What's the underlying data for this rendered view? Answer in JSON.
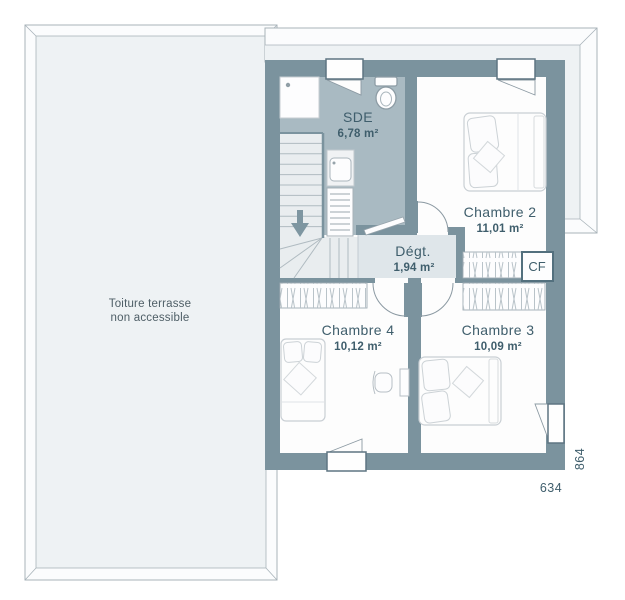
{
  "plan": {
    "rooms": [
      {
        "id": "sde",
        "name": "SDE",
        "area": "6,78 m²"
      },
      {
        "id": "chambre2",
        "name": "Chambre 2",
        "area": "11,01 m²"
      },
      {
        "id": "degagement",
        "name": "Dégt.",
        "area": "1,94 m²"
      },
      {
        "id": "chambre4",
        "name": "Chambre 4",
        "area": "10,12 m²"
      },
      {
        "id": "chambre3",
        "name": "Chambre 3",
        "area": "10,09 m²"
      }
    ],
    "terrace": {
      "label_line1": "Toiture terrasse",
      "label_line2": "non accessible"
    },
    "annotations": {
      "flue": "CF"
    },
    "dimensions": {
      "vertical": "864",
      "horizontal": "634"
    },
    "colors": {
      "wall": "#7b939e",
      "sde_floor": "#a9bac2",
      "hall_floor": "#dfe6ea",
      "stairs_floor": "#e9edef",
      "room_floor": "#fdfdfd",
      "terrace_fill": "#eef2f4",
      "terrace_band": "#fbfcfd",
      "outline": "#a8b3b9",
      "label": "#3f5e6c",
      "terrace_text": "#4e5e66"
    }
  }
}
